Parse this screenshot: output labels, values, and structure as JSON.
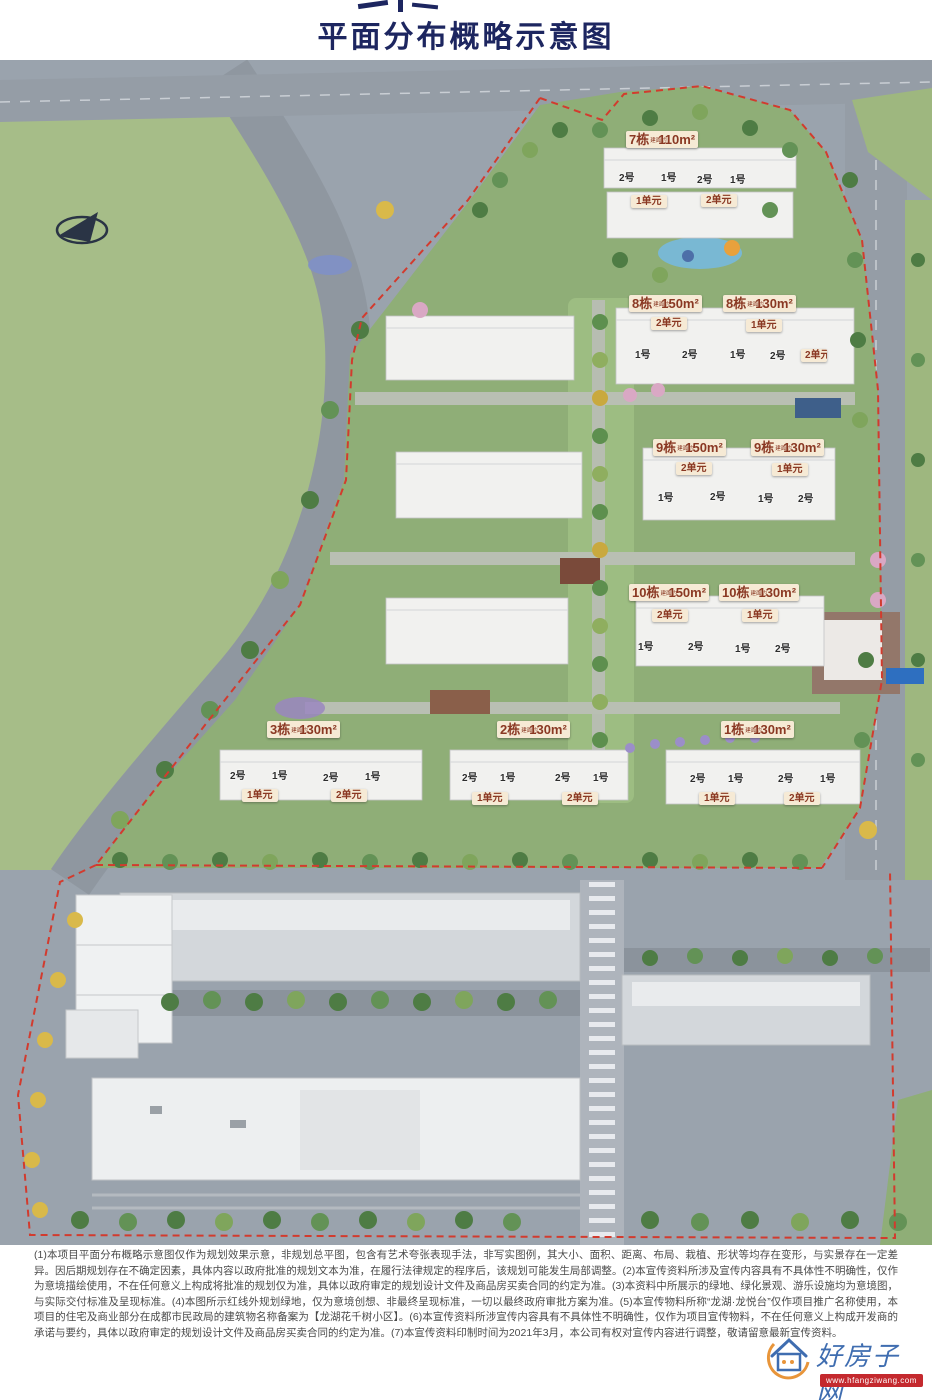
{
  "header": {
    "title": "平面分布概略示意图"
  },
  "site": {
    "area_prefix": "建面约",
    "buildings": [
      {
        "id": "7",
        "name": "7栋",
        "area": "110m²"
      },
      {
        "id": "8a",
        "name": "8栋",
        "area": "150m²"
      },
      {
        "id": "8b",
        "name": "8栋",
        "area": "130m²"
      },
      {
        "id": "9a",
        "name": "9栋",
        "area": "150m²"
      },
      {
        "id": "9b",
        "name": "9栋",
        "area": "130m²"
      },
      {
        "id": "10a",
        "name": "10栋",
        "area": "150m²"
      },
      {
        "id": "10b",
        "name": "10栋",
        "area": "130m²"
      },
      {
        "id": "3",
        "name": "3栋",
        "area": "130m²"
      },
      {
        "id": "2",
        "name": "2栋",
        "area": "130m²"
      },
      {
        "id": "1",
        "name": "1栋",
        "area": "130m²"
      }
    ],
    "unit_no_1": "1号",
    "unit_no_2": "2号",
    "section_1": "1单元",
    "section_2": "2单元"
  },
  "disclaimer": "(1)本项目平面分布概略示意图仅作为规划效果示意，非规划总平图，包含有艺术夸张表现手法，非写实图例，其大小、面积、距离、布局、栽植、形状等均存在变形，与实景存在一定差异。因后期规划存在不确定因素，具体内容以政府批准的规划文本为准，在履行法律规定的程序后，该规划可能发生局部调整。(2)本宣传资料所涉及宣传内容具有不具体性不明确性，仅作为意境描绘使用，不在任何意义上构成将批准的规划仅为准，具体以政府审定的规划设计文件及商品房买卖合同的约定为准。(3)本资料中所展示的绿地、绿化景观、游乐设施均为意境图，与实际交付标准及呈现标准。(4)本图所示红线外规划绿地，仅为意境创想、非最终呈现标准，一切以最终政府审批方案为准。(5)本宣传物料所称“龙湖·龙悦台”仅作项目推广名称使用，本项目的住宅及商业部分在成都市民政局的建筑物名称备案为【龙湖花千树小区】。(6)本宣传资料所涉宣传内容具有不具体性不明确性，仅作为项目宣传物料，不在任何意义上构成开发商的承诺与要约，具体以政府审定的规划设计文件及商品房买卖合同的约定为准。(7)本宣传资料印制时间为2021年3月，本公司有权对宣传内容进行调整，敬请留意最新宣传资料。",
  "watermark": {
    "name": "好房子网",
    "url": "www.hfangziwang.com"
  },
  "colors": {
    "title_navy": "#1d2660",
    "boundary_red": "#d23b2e",
    "chip_bg": "#f6ead5",
    "chip_text": "#8a3823",
    "site_green": "#8fae77",
    "road_gray": "#959da6",
    "watermark_blue": "#3f6db0",
    "watermark_banner_red": "#c4292e"
  }
}
